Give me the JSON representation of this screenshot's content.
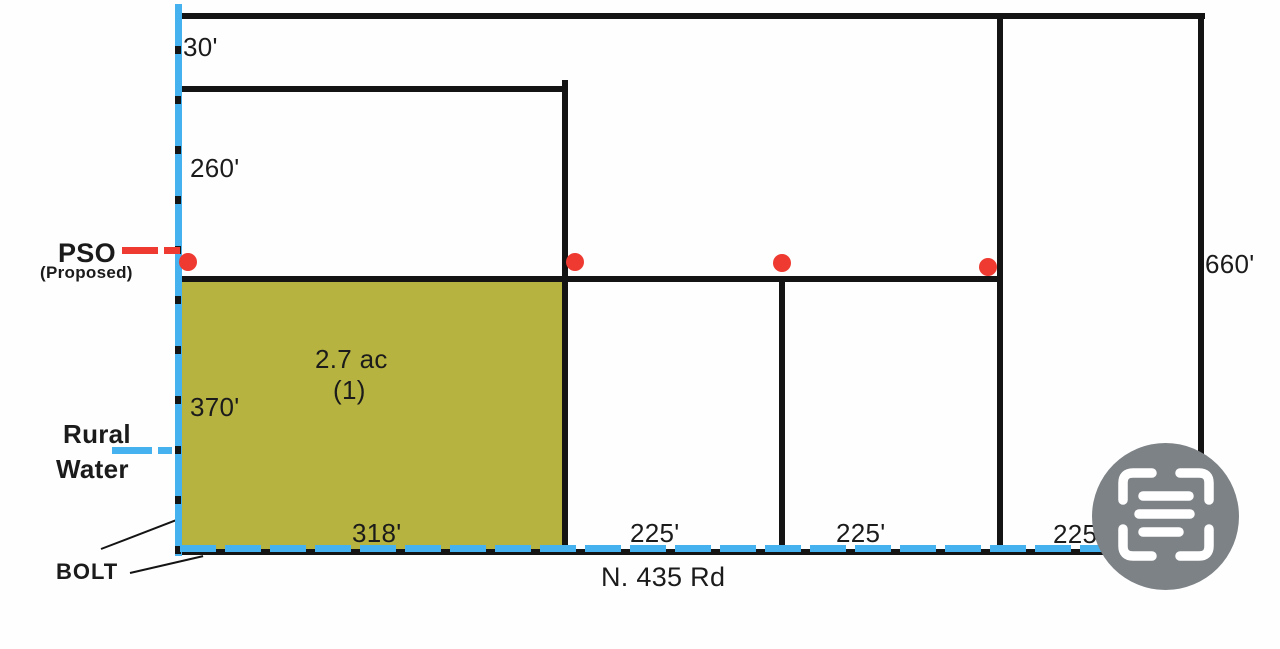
{
  "colors": {
    "line": "#141414",
    "water": "#45b1ee",
    "pso_red": "#ee3a31",
    "lot_fill": "#b6b340",
    "watermark": "#7d8286",
    "text": "#1b1b1b"
  },
  "dimensions": {
    "north_strip": "30'",
    "upper_parcel": "260'",
    "lot1_depth": "370'",
    "lot1_frontage": "318'",
    "east_boundary": "660'"
  },
  "lot1": {
    "area": "2.7 ac",
    "number": "(1)"
  },
  "lot_frontages": [
    "225'",
    "225'",
    "225'"
  ],
  "utilities": {
    "pso_label": "PSO",
    "pso_sub": "(Proposed)",
    "water_line1": "Rural",
    "water_line2": "Water",
    "bolt_label": "BOLT"
  },
  "road": {
    "name": "N. 435 Rd"
  },
  "watermark": {
    "icon": "scan-document-icon"
  }
}
